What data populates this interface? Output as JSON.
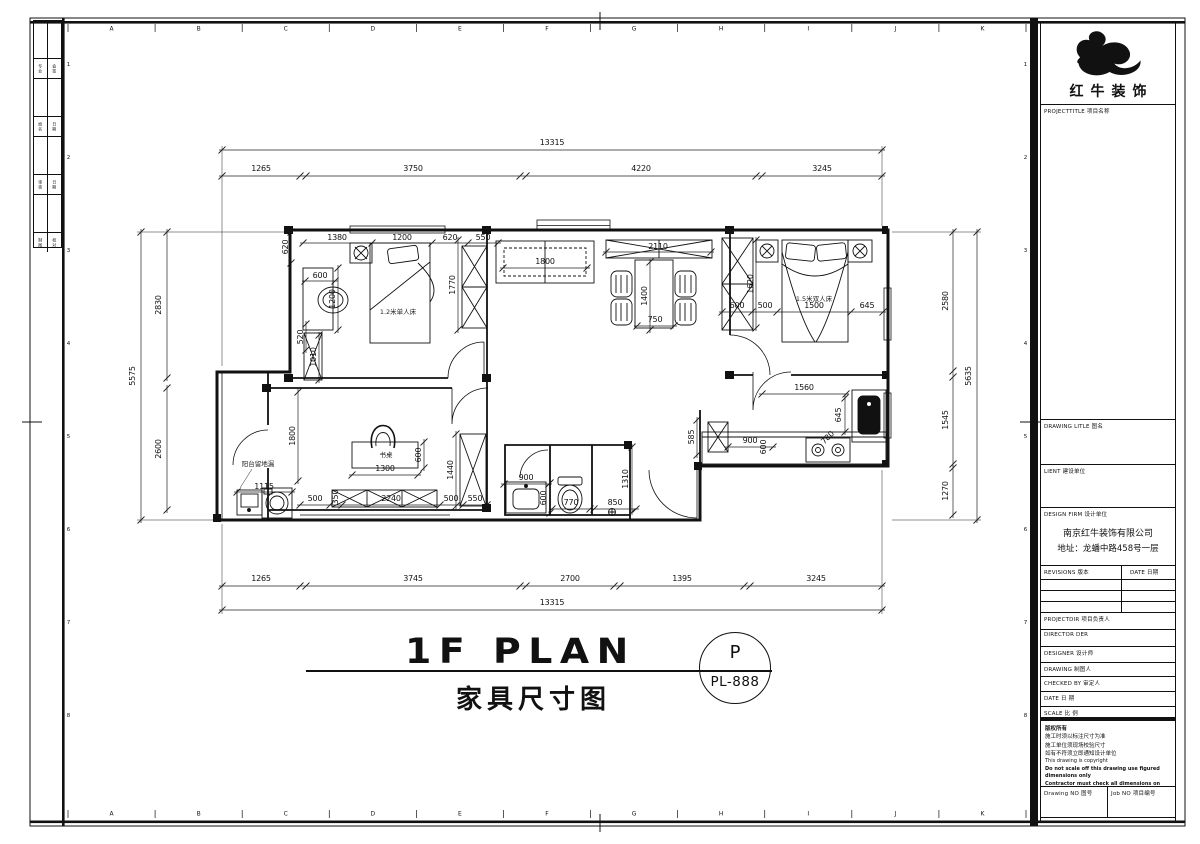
{
  "sheet": {
    "grid_letters": [
      "A",
      "B",
      "C",
      "D",
      "E",
      "F",
      "G",
      "H",
      "I",
      "J",
      "K"
    ],
    "grid_numbers": [
      "1",
      "2",
      "3",
      "4",
      "5",
      "6",
      "7",
      "8"
    ],
    "signature_rows": [
      [
        "专业",
        "会签"
      ],
      [
        "姓名",
        "日期"
      ],
      [
        "审核",
        "日期"
      ],
      [
        "制图",
        "校对"
      ]
    ]
  },
  "title_block": {
    "logo_text": "红牛装饰",
    "project_title_label": "PROJECTTITLE 项目名称",
    "drawing_title_label": "DRAWING LITLE 图名",
    "client_label": "LIENT 建设单位",
    "design_firm_label": "DESIGN FIRM 设计单位",
    "firm_name": "南京红牛装饰有限公司",
    "firm_address": "地址：龙蟠中路458号一层",
    "revisions_label": "REVISIONS 版本",
    "revisions_date_label": "DATE 日期",
    "project_dir_label": "PROJECTDIR 项目负责人",
    "director_label": "DIRECTOR DER",
    "designer_label": "DESIGNER 设计师",
    "drawing_label": "DRAWING 制图人",
    "checked_label": "CHECKED BY 审定人",
    "date_label": "DATE 日 期",
    "scale_label": "SCALE 比 例",
    "copyright_lines": [
      "版权所有",
      "施工时须以标注尺寸为准",
      "施工单位须现场校验尺寸",
      "如有不符须立即通知设计单位",
      "This drawing is copyright",
      "Do not scale off this drawing use figured dimensions only",
      "Contractor must check all dimensions on site",
      "Discrepancy must be reported immediately to architects"
    ],
    "drawing_no_label": "Drawing NO 图号",
    "job_no_label": "Job NO 项目编号"
  },
  "plan": {
    "title": "1F PLAN",
    "subtitle": "家具尺寸图",
    "stamp": {
      "letter": "P",
      "code": "PL-888"
    },
    "annotations": [
      {
        "text": "13315",
        "x": 552,
        "y": 143
      },
      {
        "text": "1265",
        "x": 261,
        "y": 169
      },
      {
        "text": "3750",
        "x": 413,
        "y": 169
      },
      {
        "text": "4220",
        "x": 641,
        "y": 169
      },
      {
        "text": "3245",
        "x": 822,
        "y": 169
      },
      {
        "text": "1265",
        "x": 261,
        "y": 579
      },
      {
        "text": "3745",
        "x": 413,
        "y": 579
      },
      {
        "text": "2700",
        "x": 570,
        "y": 579
      },
      {
        "text": "1395",
        "x": 682,
        "y": 579
      },
      {
        "text": "3245",
        "x": 816,
        "y": 579
      },
      {
        "text": "13315",
        "x": 552,
        "y": 603
      },
      {
        "text": "5575",
        "x": 133,
        "y": 376,
        "rot": -90
      },
      {
        "text": "2830",
        "x": 159,
        "y": 305,
        "rot": -90
      },
      {
        "text": "2600",
        "x": 159,
        "y": 449,
        "rot": -90
      },
      {
        "text": "2580",
        "x": 946,
        "y": 301,
        "rot": -90
      },
      {
        "text": "1545",
        "x": 946,
        "y": 420,
        "rot": -90
      },
      {
        "text": "1270",
        "x": 946,
        "y": 491,
        "rot": -90
      },
      {
        "text": "5635",
        "x": 969,
        "y": 376,
        "rot": -90
      },
      {
        "text": "620",
        "x": 286,
        "y": 247,
        "rot": -90
      },
      {
        "text": "1380",
        "x": 337,
        "y": 238
      },
      {
        "text": "1200",
        "x": 402,
        "y": 238
      },
      {
        "text": "620",
        "x": 450,
        "y": 238
      },
      {
        "text": "550",
        "x": 483,
        "y": 238
      },
      {
        "text": "600",
        "x": 320,
        "y": 276
      },
      {
        "text": "1200",
        "x": 333,
        "y": 299,
        "rot": -90
      },
      {
        "text": "520",
        "x": 301,
        "y": 337,
        "rot": -90
      },
      {
        "text": "1010",
        "x": 314,
        "y": 357,
        "rot": -90
      },
      {
        "text": "1770",
        "x": 453,
        "y": 285,
        "rot": -90
      },
      {
        "text": "1.2米单人床",
        "x": 398,
        "y": 312,
        "kind": "room"
      },
      {
        "text": "1800",
        "x": 545,
        "y": 262
      },
      {
        "text": "2110",
        "x": 658,
        "y": 247
      },
      {
        "text": "1400",
        "x": 645,
        "y": 296,
        "rot": -90
      },
      {
        "text": "750",
        "x": 655,
        "y": 320
      },
      {
        "text": "1620",
        "x": 751,
        "y": 284,
        "rot": -90
      },
      {
        "text": "600",
        "x": 737,
        "y": 306
      },
      {
        "text": "500",
        "x": 765,
        "y": 306
      },
      {
        "text": "1500",
        "x": 814,
        "y": 306
      },
      {
        "text": "1.5米双人床",
        "x": 814,
        "y": 299,
        "kind": "room"
      },
      {
        "text": "645",
        "x": 867,
        "y": 306
      },
      {
        "text": "1560",
        "x": 804,
        "y": 388
      },
      {
        "text": "645",
        "x": 839,
        "y": 415,
        "rot": -90
      },
      {
        "text": "585",
        "x": 692,
        "y": 437,
        "rot": -90
      },
      {
        "text": "900",
        "x": 750,
        "y": 441
      },
      {
        "text": "600",
        "x": 764,
        "y": 447,
        "rot": -90
      },
      {
        "text": "780",
        "x": 828,
        "y": 438,
        "rot": -45
      },
      {
        "text": "900",
        "x": 526,
        "y": 478
      },
      {
        "text": "600",
        "x": 544,
        "y": 498,
        "rot": -90
      },
      {
        "text": "770",
        "x": 571,
        "y": 503
      },
      {
        "text": "850",
        "x": 615,
        "y": 503
      },
      {
        "text": "1310",
        "x": 626,
        "y": 479,
        "rot": -90
      },
      {
        "text": "1800",
        "x": 293,
        "y": 436,
        "rot": -90
      },
      {
        "text": "书桌",
        "x": 386,
        "y": 455,
        "kind": "room"
      },
      {
        "text": "600",
        "x": 419,
        "y": 455,
        "rot": -90
      },
      {
        "text": "1300",
        "x": 385,
        "y": 469
      },
      {
        "text": "1440",
        "x": 451,
        "y": 470,
        "rot": -90
      },
      {
        "text": "500",
        "x": 315,
        "y": 499
      },
      {
        "text": "350",
        "x": 336,
        "y": 497,
        "rot": -90
      },
      {
        "text": "2240",
        "x": 391,
        "y": 499
      },
      {
        "text": "500",
        "x": 451,
        "y": 499
      },
      {
        "text": "550",
        "x": 475,
        "y": 499
      },
      {
        "text": "阳台留地漏",
        "x": 258,
        "y": 464,
        "kind": "room"
      },
      {
        "text": "1115",
        "x": 264,
        "y": 487
      }
    ]
  }
}
